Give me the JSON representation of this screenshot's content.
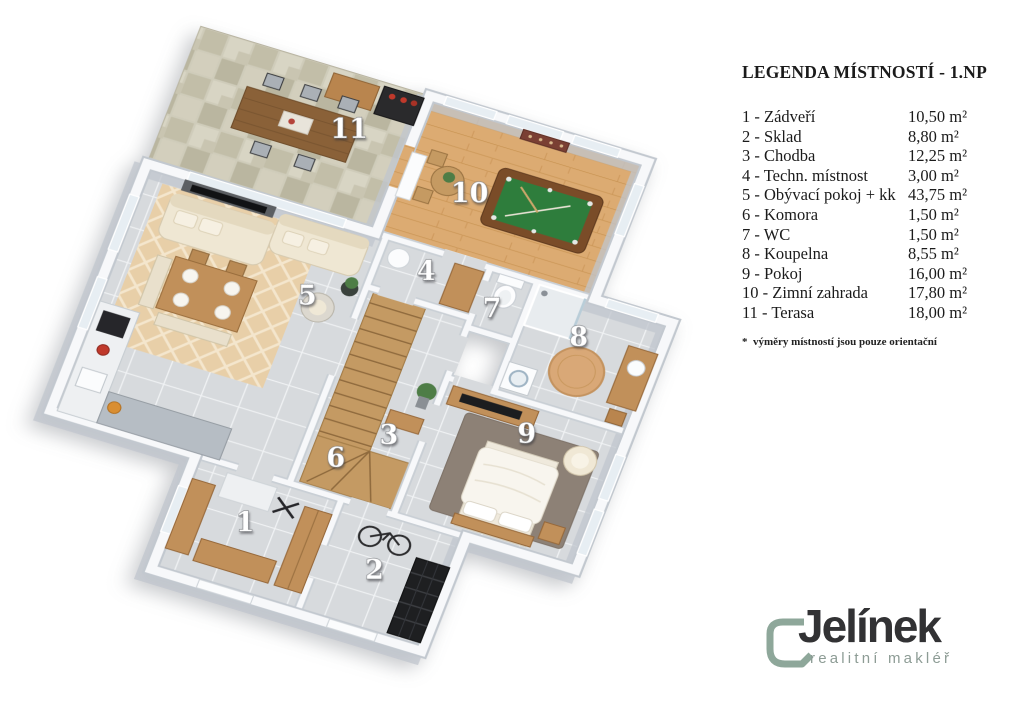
{
  "legend": {
    "title": "LEGENDA MÍSTNOSTÍ - 1.NP",
    "note": "*  výměry místností jsou pouze orientační",
    "rooms": [
      {
        "number": "1",
        "name": "Zádveří",
        "label": "1 - Zádveří",
        "area": "10,50 m²"
      },
      {
        "number": "2",
        "name": "Sklad",
        "label": "2 - Sklad",
        "area": "8,80 m²"
      },
      {
        "number": "3",
        "name": "Chodba",
        "label": "3 - Chodba",
        "area": "12,25 m²"
      },
      {
        "number": "4",
        "name": "Techn. místnost",
        "label": "4 - Techn. místnost",
        "area": "3,00 m²"
      },
      {
        "number": "5",
        "name": "Obývací pokoj + kk",
        "label": "5 - Obývací pokoj + kk",
        "area": "43,75 m²"
      },
      {
        "number": "6",
        "name": "Komora",
        "label": "6 - Komora",
        "area": "1,50 m²"
      },
      {
        "number": "7",
        "name": "WC",
        "label": "7 - WC",
        "area": "1,50 m²"
      },
      {
        "number": "8",
        "name": "Koupelna",
        "label": "8 - Koupelna",
        "area": "8,55 m²"
      },
      {
        "number": "9",
        "name": "Pokoj",
        "label": "9 - Pokoj",
        "area": "16,00 m²"
      },
      {
        "number": "10",
        "name": "Zimní zahrada",
        "label": "10 - Zimní zahrada",
        "area": "17,80 m²"
      },
      {
        "number": "11",
        "name": "Terasa",
        "label": "11 - Terasa",
        "area": "18,00 m²"
      }
    ]
  },
  "brand": {
    "name": "Jelínek",
    "tagline": "realitní makléř",
    "mark_color": "#8ea79a",
    "text_color": "#323234"
  },
  "colors": {
    "tile_floor": "#d7dadd",
    "wood_floor": "#dcab72",
    "stone_terrace": "#cfccba",
    "walls": "#f7f8fa",
    "pool_felt": "#2e7d3c",
    "bed_rug": "#8d8176",
    "accent_wood": "#c1905a"
  }
}
